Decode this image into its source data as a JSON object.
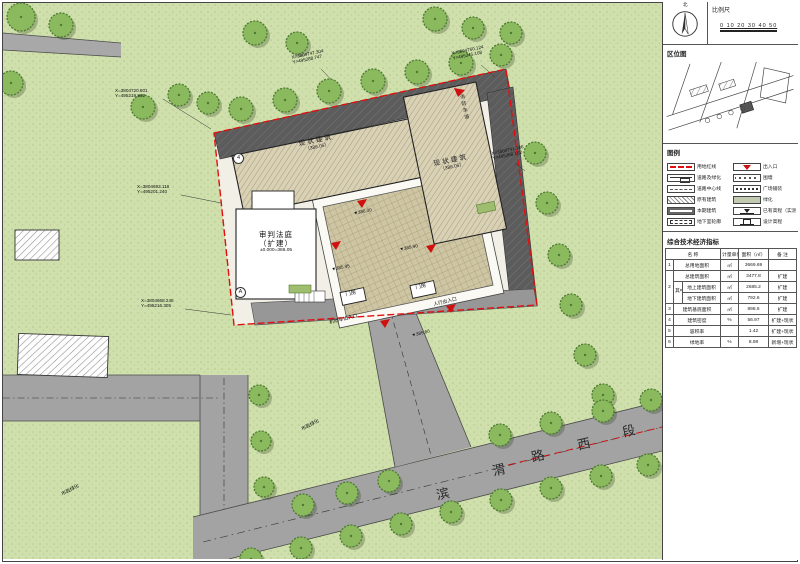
{
  "page": {
    "accent_red": "#e01010",
    "grass": "#cfe0ac",
    "road_grey": "#a3a3a3"
  },
  "panel": {
    "north_label": "北",
    "scale_label": "比例尺",
    "scale_ticks": "0  10  20  30  40  50",
    "location_title": "区位图",
    "legend_title": "图例",
    "legend_left": [
      {
        "label": "用地红线"
      },
      {
        "label": "道路及绿化"
      },
      {
        "label": "道路中心线"
      },
      {
        "label": "原有建筑"
      },
      {
        "label": "本期建筑"
      },
      {
        "label": "地下室轮廓"
      }
    ],
    "legend_right": [
      {
        "label": "出入口"
      },
      {
        "label": "围墙"
      },
      {
        "label": "广场铺装"
      },
      {
        "label": "绿化"
      },
      {
        "label": "已有高程（实测）"
      },
      {
        "label": "设计高程"
      }
    ],
    "table": {
      "title": "综合技术经济指标",
      "col_name": "名 称",
      "col_unit": "计量单位",
      "col_area": "面积（㎡）",
      "col_note": "备 注",
      "rows": {
        "r1": {
          "no": "1",
          "name": "总用地面积",
          "unit": "㎡",
          "area": "3669.69",
          "note": ""
        },
        "r2": {
          "no": "2",
          "name": "总建筑面积",
          "unit": "㎡",
          "area": "3477.8",
          "note": "扩建"
        },
        "r2group": "其中",
        "r2a": {
          "name": "地上建筑面积",
          "unit": "㎡",
          "area": "2685.2",
          "note": "扩建"
        },
        "r2b": {
          "name": "地下建筑面积",
          "unit": "㎡",
          "area": "792.6",
          "note": "扩建"
        },
        "r3": {
          "no": "3",
          "name": "建筑基底面积",
          "unit": "㎡",
          "area": "898.6",
          "note": "扩建"
        },
        "r4": {
          "no": "4",
          "name": "建筑密度",
          "unit": "%",
          "area": "56.97",
          "note": "扩建+现状"
        },
        "r5": {
          "no": "5",
          "name": "容积率",
          "unit": "",
          "area": "1.42",
          "note": "扩建+现状"
        },
        "r6": {
          "no": "6",
          "name": "绿地率",
          "unit": "%",
          "area": "8.98",
          "note": "新增+现状"
        }
      }
    }
  },
  "plan": {
    "road_name": [
      "滨",
      "渭",
      "路",
      "西",
      "段"
    ],
    "labels": {
      "bldg_a": "现状建筑",
      "bldg_a_sub": "（386.05）",
      "bldg_b": "现状建筑",
      "bldg_b_sub": "（386.05）",
      "court_1": "审判法庭",
      "court_2": "（扩建）",
      "court_3": "±0.000=386.05",
      "gate_1": "门房",
      "gate_2": "门房",
      "fire_lane": "消防车道",
      "green_1": "市政绿化",
      "green_2": "市政绿化",
      "ent_vehicle": "机动车出入口",
      "ent_ped": "人行出入口",
      "marker_a": "A",
      "marker_4": "4",
      "elev_1": "▼386.00",
      "elev_2": "▼385.95",
      "elev_3": "▼385.90",
      "elev_4": "▼385.60"
    },
    "coords": [
      {
        "x": "X=3804747.304",
        "y": "Y=495288.747"
      },
      {
        "x": "X=3804760.124",
        "y": "Y=495345.108"
      },
      {
        "x": "X=3804720.801",
        "y": "Y=495219.862"
      },
      {
        "x": "X=3804693.118",
        "y": "Y=495201.240"
      },
      {
        "x": "X=3804668.245",
        "y": "Y=495216.305"
      },
      {
        "x": "X=3804741.186",
        "y": "Y=495368.102"
      }
    ]
  }
}
